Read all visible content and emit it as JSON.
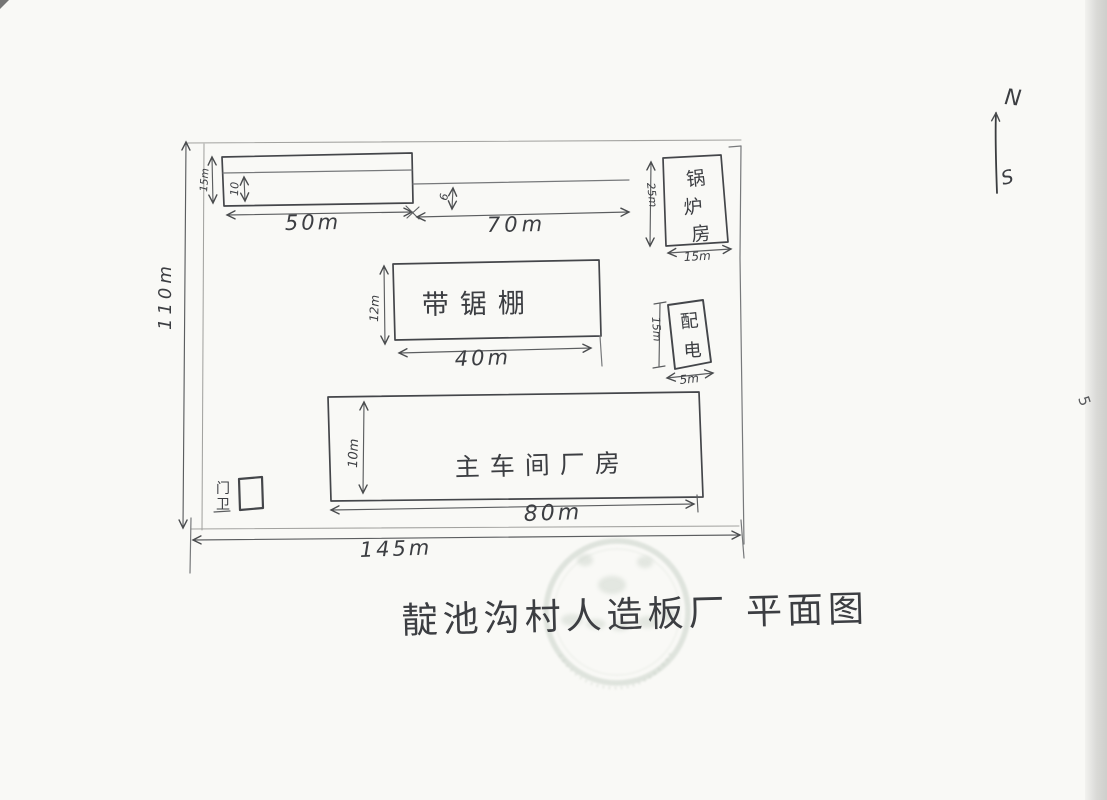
{
  "title": "靛池沟村人造板厂 平面图",
  "page_mark": "5",
  "compass": {
    "north_label": "N",
    "south_label": "S"
  },
  "site": {
    "height_label": "110m",
    "width_label": "145m"
  },
  "buildings": {
    "north_shed": {
      "height_label": "15m",
      "inner_height_label": "10",
      "width_label": "50m"
    },
    "north_strip": {
      "width_label": "70m",
      "gap_label": "6"
    },
    "boiler_room": {
      "name": "锅炉房",
      "chars": [
        "锅",
        "炉",
        "房"
      ],
      "height_label": "25m",
      "width_label": "15m"
    },
    "power_room": {
      "name": "配电",
      "chars": [
        "配",
        "电"
      ],
      "height_label": "15m",
      "width_label": "5m"
    },
    "saw_shed": {
      "name": "带锯棚",
      "height_label": "12m",
      "width_label": "40m"
    },
    "main_workshop": {
      "name": "主车间厂房",
      "height_label": "10m",
      "width_label": "80m"
    },
    "gatehouse": {
      "name": "门卫",
      "chars": [
        "门",
        "卫"
      ]
    }
  },
  "colors": {
    "pencil": "#44464a",
    "stamp": "#9aab9b"
  }
}
